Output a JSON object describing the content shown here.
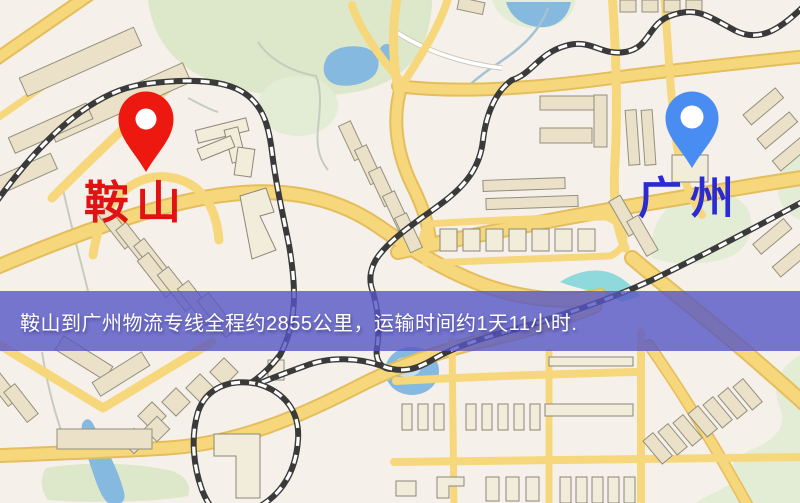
{
  "map": {
    "type": "street-map",
    "origin": {
      "label": "鞍山",
      "pin_color": "#ed1910",
      "label_color": "#e01212"
    },
    "destination": {
      "label": "广州",
      "pin_color": "#4a8df2",
      "label_color": "#2b2bd2"
    }
  },
  "banner": {
    "text": "鞍山到广州物流专线全程约2855公里，运输时间约1天11小时.",
    "background_color": "rgba(86,86,198,0.8)",
    "text_color": "#ffffff"
  },
  "route": {
    "origin": "鞍山",
    "destination": "广州",
    "distance": "约2855公里",
    "duration": "约1天11小时"
  }
}
